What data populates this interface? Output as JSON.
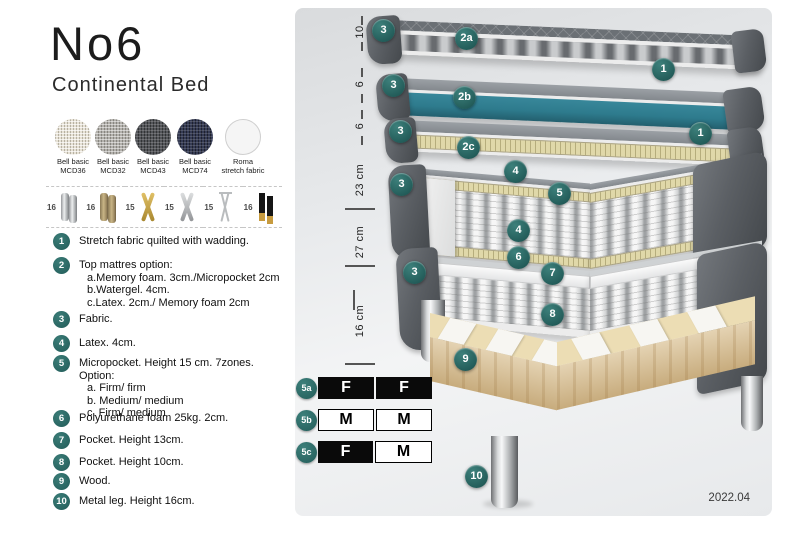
{
  "product": {
    "title": "No6",
    "subtitle": "Continental Bed"
  },
  "fabrics": [
    {
      "line1": "Bell basic",
      "line2": "MCD36"
    },
    {
      "line1": "Bell basic",
      "line2": "MCD32"
    },
    {
      "line1": "Bell basic",
      "line2": "MCD43"
    },
    {
      "line1": "Bell basic",
      "line2": "MCD74"
    },
    {
      "line1": "Roma",
      "line2": "stretch fabric"
    }
  ],
  "legs_options": [
    {
      "height": "16",
      "type": "chrome-cylinder-legs"
    },
    {
      "height": "16",
      "type": "wood-cylinder-legs"
    },
    {
      "height": "15",
      "type": "gold-cross-legs"
    },
    {
      "height": "15",
      "type": "silver-cross-legs"
    },
    {
      "height": "15",
      "type": "hairpin-legs"
    },
    {
      "height": "16",
      "type": "black-gold-tip-legs"
    }
  ],
  "features": [
    {
      "num": "1",
      "text": "Stretch fabric quilted with wadding."
    },
    {
      "num": "2",
      "text": "Top mattres option:",
      "sub": [
        "a.Memory foam. 3cm./Micropocket 2cm",
        "b.Watergel. 4cm.",
        "c.Latex. 2cm./ Memory foam 2cm"
      ]
    },
    {
      "num": "3",
      "text": "Fabric."
    },
    {
      "num": "4",
      "text": "Latex. 4cm."
    },
    {
      "num": "5",
      "text": "Micropocket. Height 15 cm. 7zones. Option:",
      "sub": [
        "a. Firm/ firm",
        "b. Medium/ medium",
        "c. Firm/ medium"
      ]
    },
    {
      "num": "6",
      "text": "Polyurethane foam 25kg. 2cm."
    },
    {
      "num": "7",
      "text": "Pocket. Height 13cm."
    },
    {
      "num": "8",
      "text": "Pocket. Height 10cm."
    },
    {
      "num": "9",
      "text": "Wood."
    },
    {
      "num": "10",
      "text": "Metal leg. Height 16cm."
    }
  ],
  "diagram": {
    "ruler": [
      "10",
      "6",
      "6",
      "23 cm",
      "27 cm",
      "16 cm"
    ],
    "callouts": [
      "3",
      "2a",
      "1",
      "3",
      "2b",
      "1",
      "3",
      "2c",
      "4",
      "5",
      "3",
      "4",
      "6",
      "7",
      "3",
      "8",
      "9",
      "10"
    ],
    "firmness": [
      {
        "id": "5a",
        "cells": [
          {
            "v": "F",
            "fill": "black"
          },
          {
            "v": "F",
            "fill": "black"
          }
        ]
      },
      {
        "id": "5b",
        "cells": [
          {
            "v": "M",
            "fill": "white"
          },
          {
            "v": "M",
            "fill": "white"
          }
        ]
      },
      {
        "id": "5c",
        "cells": [
          {
            "v": "F",
            "fill": "black"
          },
          {
            "v": "M",
            "fill": "white"
          }
        ]
      }
    ],
    "version_label": "2022.04",
    "colors": {
      "accent_teal": "#2b6a67",
      "layer_teal": "#2e7b8d",
      "wood": "#dcc394",
      "latex_cream": "#e0d8a9"
    }
  }
}
